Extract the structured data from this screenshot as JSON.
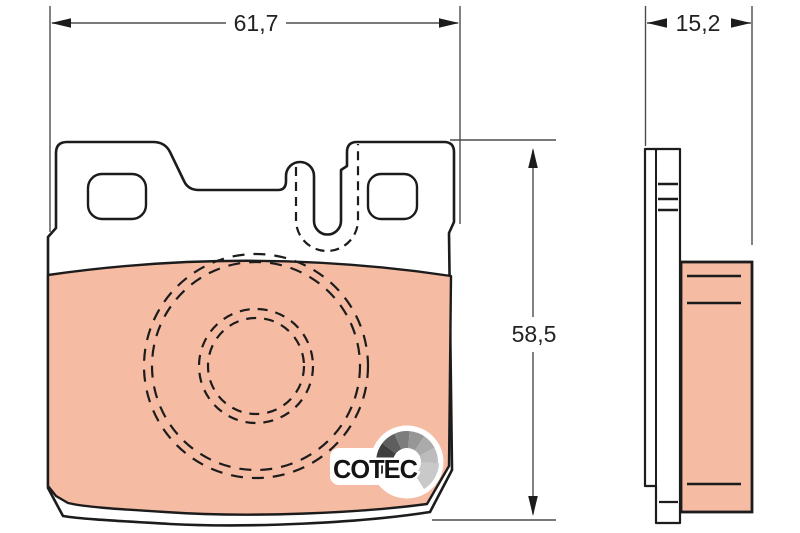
{
  "dimensions": {
    "width": "61,7",
    "thickness": "15,2",
    "height": "58,5"
  },
  "logo": {
    "text": "COTEC"
  },
  "colors": {
    "background": "#ffffff",
    "friction_material": "#f5bba3",
    "part_outline": "#1c1c1c",
    "dimension_lines": "#4d4d4d",
    "logo_fan_segments": [
      "#141414",
      "#3f3f3f",
      "#5e5e5e",
      "#7d7d7d",
      "#969696",
      "#ababab",
      "#bcbcbc",
      "#c9c9c9"
    ]
  }
}
